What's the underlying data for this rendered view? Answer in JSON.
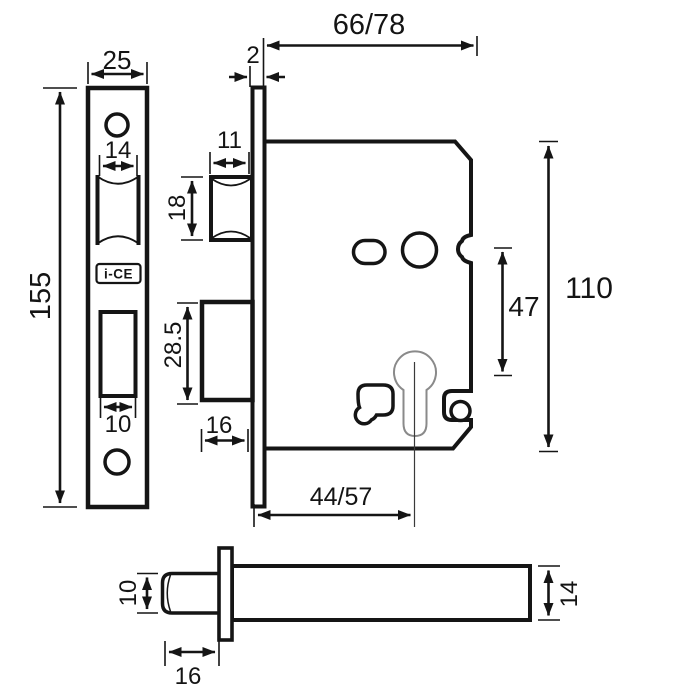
{
  "diagram": {
    "brand": "i-CE",
    "dims": {
      "plate_width": "25",
      "plate_height": "155",
      "latch_cutout_width": "14",
      "bolt_cutout_width": "10",
      "plate_thickness": "2",
      "case_depth": "66/78",
      "latch_width": "11",
      "latch_height": "18",
      "bolt_height": "28.5",
      "bolt_width": "16",
      "backset": "44/57",
      "centres": "47",
      "case_height": "110",
      "spindle_height": "10",
      "spindle_length": "16",
      "case_thickness": "14"
    }
  }
}
